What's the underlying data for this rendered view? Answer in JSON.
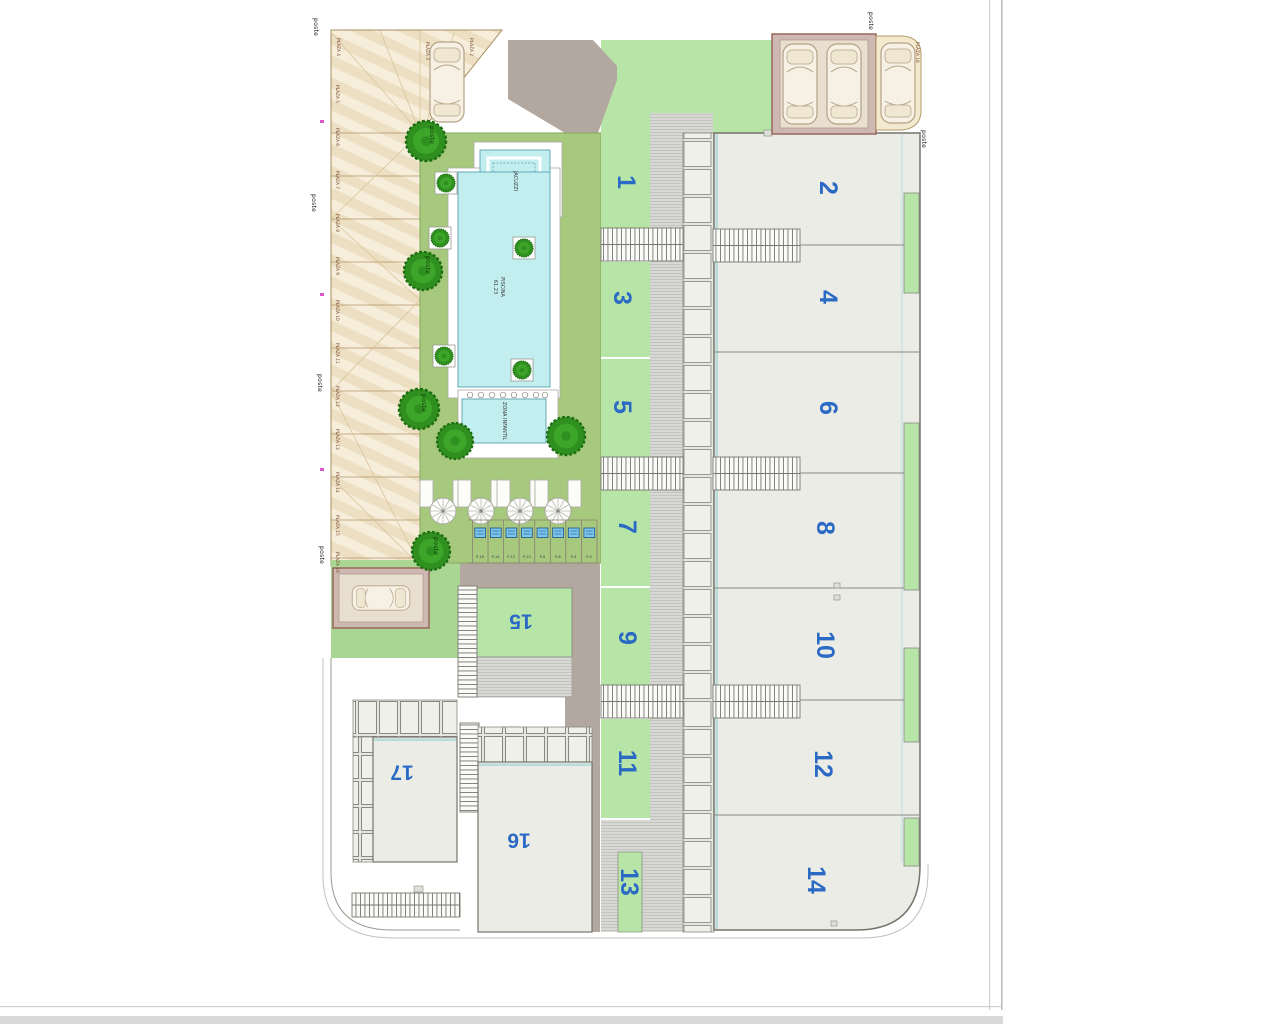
{
  "site_plan": {
    "unit_numbers": [
      "1",
      "2",
      "3",
      "4",
      "5",
      "6",
      "7",
      "8",
      "9",
      "10",
      "11",
      "12",
      "13",
      "14",
      "15",
      "16",
      "17"
    ],
    "pool": {
      "jacuzzi_label": "JACUZZI",
      "pool_label": "PISCINA",
      "pool_area": "61.23",
      "kids_zone_label": "ZONA INFANTIL"
    },
    "poste_label": "poste",
    "parking_spaces": {
      "top_row": [
        "PLAZA 4",
        "PLAZA 3",
        "PLAZA 2"
      ],
      "left_column": [
        "PLAZA 5",
        "PLAZA 6",
        "PLAZA 7",
        "PLAZA 8",
        "PLAZA 9",
        "PLAZA 10",
        "PLAZA 11",
        "PLAZA 12",
        "PLAZA 13",
        "PLAZA 14",
        "PLAZA 15",
        "PLAZA 16"
      ],
      "top_right": "PLAZA 18"
    },
    "plunge_pool_labels": [
      "P-16",
      "P-14",
      "P-12",
      "P-10",
      "P-8",
      "P-6",
      "P-4",
      "P-2"
    ],
    "colors": {
      "unit_number_blue": "#2b6ac4",
      "lawn_green": "#b7e5a8",
      "garden_olive": "#a6c97d",
      "pool_cyan": "#c2eef0",
      "road_taupe": "#b2a8a0",
      "parking_beige": "#ecdfc2",
      "canopy_mauve": "#cdb9b1"
    }
  }
}
